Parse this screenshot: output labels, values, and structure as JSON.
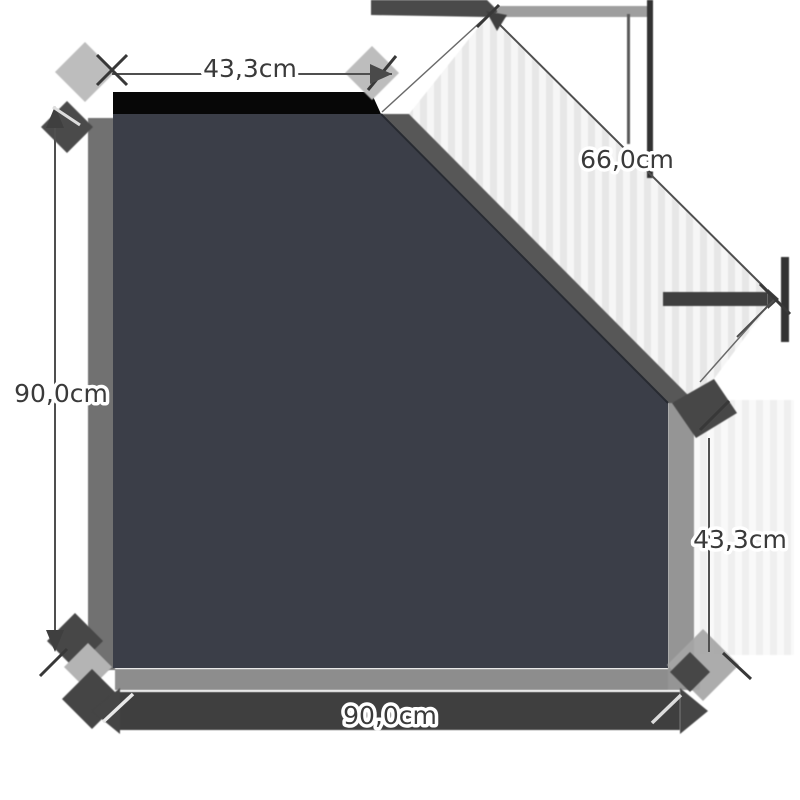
{
  "diagram": {
    "title": "pentagon-plate-dimension-drawing",
    "shape": "square-plate-with-cut-corner",
    "unit": "cm",
    "dimensions": [
      {
        "side": "top",
        "label": "43,3cm"
      },
      {
        "side": "diagonal",
        "label": "66,0cm"
      },
      {
        "side": "left",
        "label": "90,0cm"
      },
      {
        "side": "right",
        "label": "43,3cm"
      },
      {
        "side": "bottom",
        "label": "90,0cm"
      }
    ],
    "colors": {
      "background": "#ffffff",
      "plate": "#3b3e48",
      "plate_edge": "#272a31",
      "top_shadow": "#070707",
      "dim_ink": "#3f3f3f",
      "dim_line": "#4f4f4f",
      "tick_dark": "#383838",
      "tick_light": "#e6e6e6",
      "shadow_dark": "#474747",
      "shadow_mid": "#8d8d8d",
      "shadow_light": "#bdbdbd",
      "label_text": "#3a3a3a",
      "label_halo": "#ffffff"
    }
  }
}
